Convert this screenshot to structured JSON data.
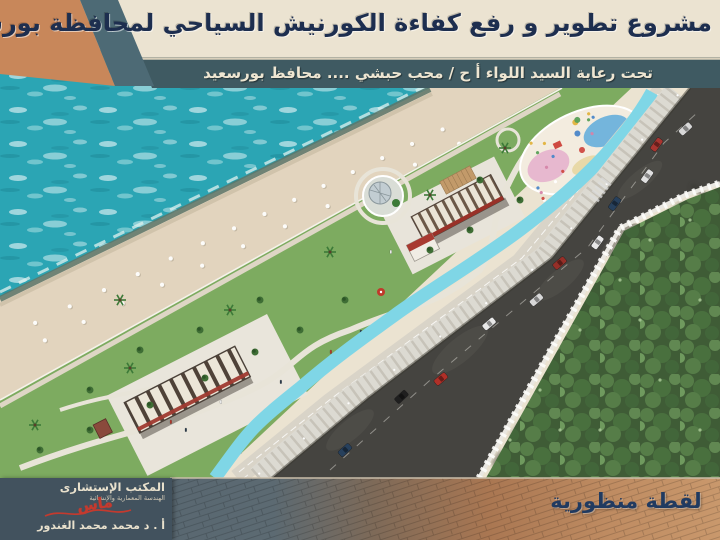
{
  "banner": {
    "title": "مشروع تطوير و رفع كفاءة الكورنيش السياحي لمحافظة بورسعيد",
    "subtitle": "تحت رعاية السيد اللواء أ ح /  محب حبشي ....  محافظ بورسعيد"
  },
  "caption": {
    "text": "لقطة منظورية"
  },
  "logo": {
    "office": "المكتب الإستشارى",
    "field": "الهندسة المعمارية والإنشائية",
    "signature": "ماس",
    "author": "أ . د محمد محمد الغندور"
  },
  "colors": {
    "banner_bg": "#ebe3d1",
    "banner_text": "#1d2e4f",
    "strip_bg": "#3f5a62",
    "strip_text": "#eee6d2",
    "corner_triangle": "#c8875a",
    "corner_stripe": "#4d6a75",
    "sea": "#2ba5b4",
    "sand": "#e2d4be",
    "lawn": "#7dab60",
    "bike_path": "#7fd6e6",
    "road": "#454440",
    "trees": "#3f5c36",
    "pavement_left": "#54646f",
    "pavement_right": "#c9986c",
    "caption_text": "#203a60",
    "logo_bg": "#42525e",
    "logo_text": "#e9e1cd",
    "signature_red": "#c43a2e"
  }
}
